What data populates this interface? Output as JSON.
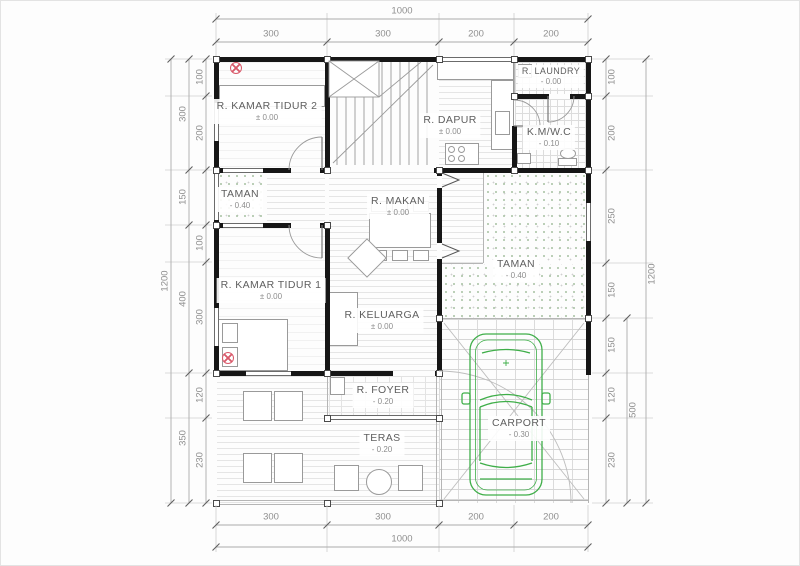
{
  "drawing": {
    "type": "house-floor-plan",
    "rooms": [
      {
        "name": "R. KAMAR TIDUR 2",
        "level": "± 0.00"
      },
      {
        "name": "R. DAPUR",
        "level": "± 0.00"
      },
      {
        "name": "R. LAUNDRY",
        "level": "- 0.00"
      },
      {
        "name": "K.M/W.C",
        "level": "- 0.10"
      },
      {
        "name": "TAMAN",
        "level": "- 0.40"
      },
      {
        "name": "R. MAKAN",
        "level": "± 0.00"
      },
      {
        "name": "TAMAN",
        "level": "- 0.40"
      },
      {
        "name": "R. KAMAR TIDUR 1",
        "level": "± 0.00"
      },
      {
        "name": "R. KELUARGA",
        "level": "± 0.00"
      },
      {
        "name": "R. FOYER",
        "level": "- 0.20"
      },
      {
        "name": "TERAS",
        "level": "- 0.20"
      },
      {
        "name": "CARPORT",
        "level": "- 0.30"
      }
    ],
    "dims": {
      "top_total": "1000",
      "top": [
        "300",
        "300",
        "200",
        "200"
      ],
      "bottom": [
        "300",
        "300",
        "200",
        "200"
      ],
      "bottom_total": "1000",
      "left_outer": "1200",
      "left_mid": [
        "300",
        "150",
        "400",
        "350"
      ],
      "left_inner": [
        "100",
        "200",
        "100",
        "300",
        "120",
        "230"
      ],
      "right_inner": [
        "100",
        "200",
        "250",
        "150",
        "150",
        "120",
        "230"
      ],
      "right_mid": "500",
      "right_outer": "1200"
    },
    "colors": {
      "wall": "#161616",
      "linework": "#9a9a9a",
      "dimension_text": "#8f8f8f",
      "car_green": "#3fae49",
      "lamp_symbol_red": "#d9596a",
      "garden_dot_green": "#a9c2a4"
    },
    "icons": [
      "lamp-icon",
      "car-icon",
      "door-swing-icon",
      "window-icon",
      "stairs-icon"
    ]
  }
}
